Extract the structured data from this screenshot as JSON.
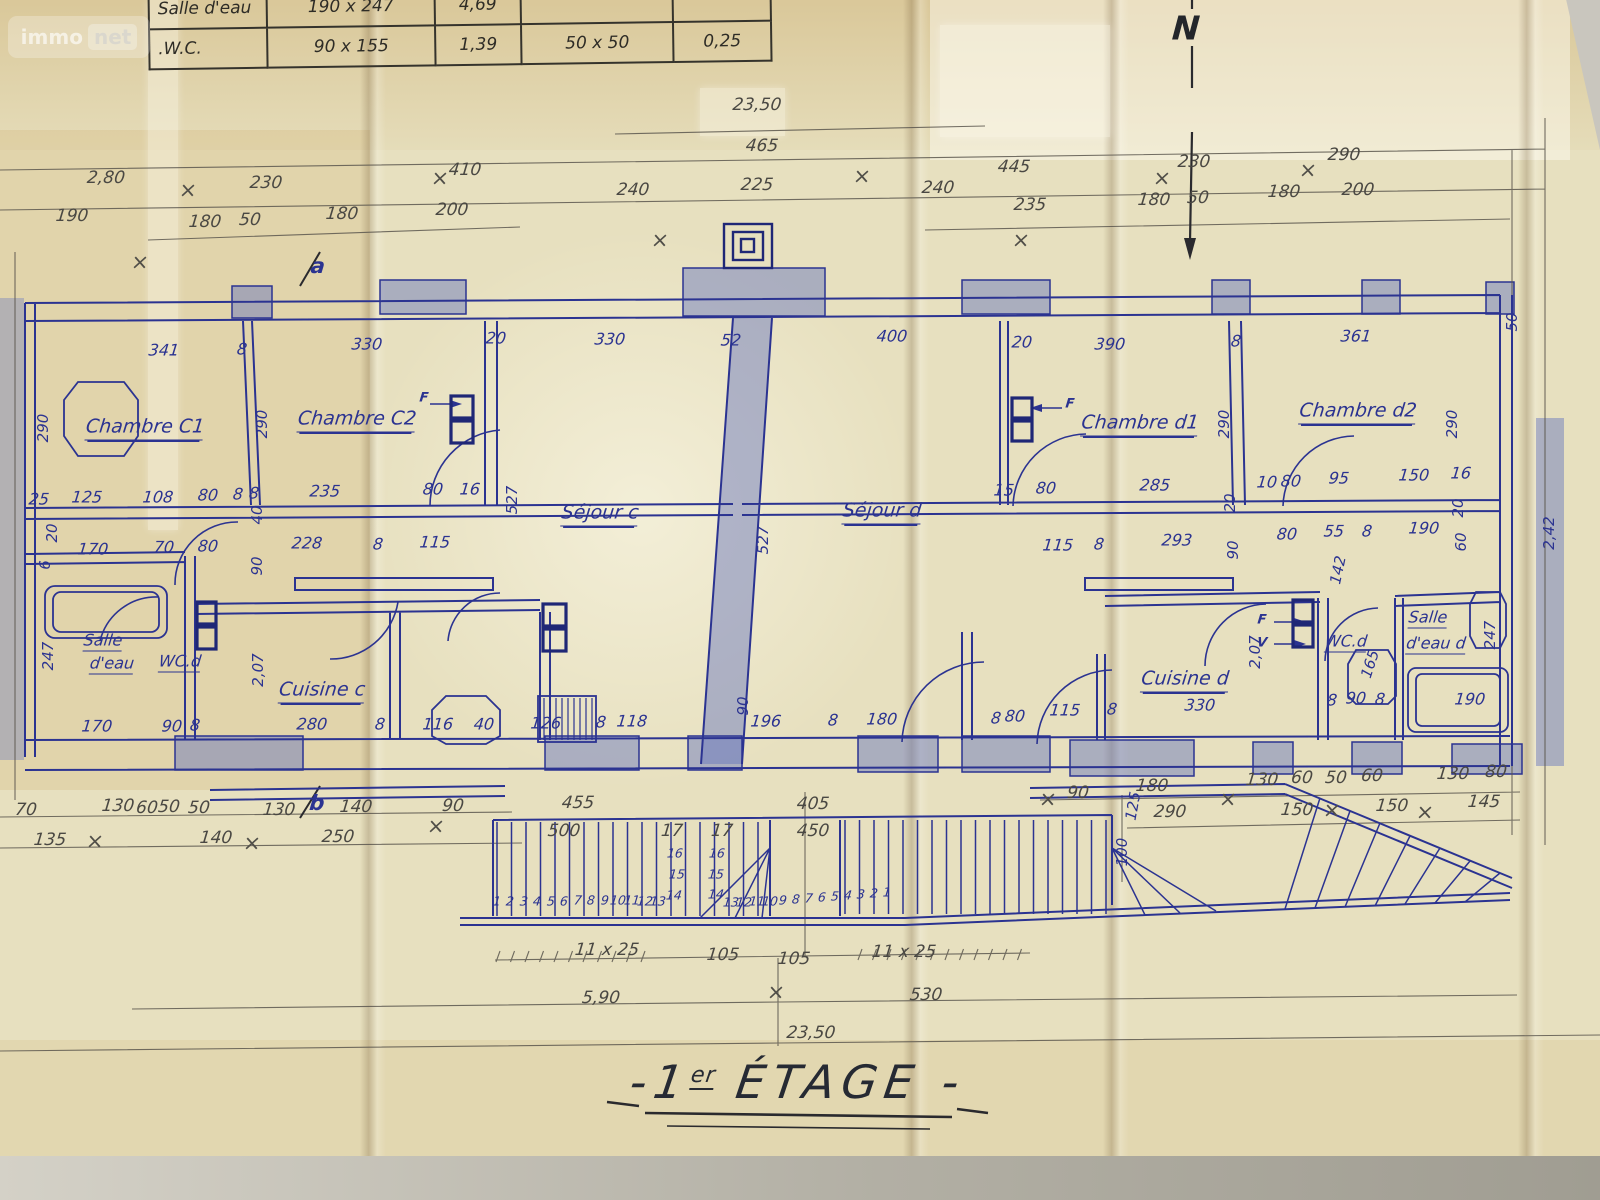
{
  "title": {
    "dash_left": "-",
    "prefix": "1",
    "sup": "er",
    "main": "ÉTAGE",
    "dash_right": "-"
  },
  "watermark": {
    "part1": "immo",
    "part2": "net"
  },
  "compass_label": "N",
  "plan_name": "1er ÉTAGE floor plan",
  "colors": {
    "paper": "#e7e0bf",
    "ink_blue": "#2b3391",
    "ink_navy": "#1f2776",
    "pencil": "#4a4843",
    "crayon": "#6878bf"
  },
  "schedule_table": {
    "rows": [
      [
        "Salle d'eau",
        "190 x 247",
        "4,69",
        "",
        ""
      ],
      [
        ".W.C.",
        "90 x 155",
        "1,39",
        "50 x 50",
        "0,25"
      ]
    ]
  },
  "labels": {
    "pencil_dims": [
      [
        "23,50",
        757,
        105
      ],
      [
        "465",
        762,
        146
      ],
      [
        "240",
        633,
        190
      ],
      [
        "225",
        757,
        185
      ],
      [
        "240",
        938,
        188
      ],
      [
        "2,80",
        106,
        178
      ],
      [
        "230",
        266,
        183
      ],
      [
        "410",
        465,
        170
      ],
      [
        "190",
        72,
        216
      ],
      [
        "180",
        205,
        222
      ],
      [
        "50",
        250,
        220
      ],
      [
        "180",
        342,
        214
      ],
      [
        "200",
        452,
        210
      ],
      [
        "445",
        1014,
        167
      ],
      [
        "230",
        1194,
        162
      ],
      [
        "290",
        1344,
        155
      ],
      [
        "235",
        1030,
        205
      ],
      [
        "180",
        1154,
        200
      ],
      [
        "50",
        1198,
        198
      ],
      [
        "180",
        1284,
        192
      ],
      [
        "200",
        1358,
        190
      ],
      [
        "70",
        26,
        810
      ],
      [
        "130",
        118,
        806
      ],
      [
        "60",
        147,
        808
      ],
      [
        "50",
        169,
        807
      ],
      [
        "50",
        199,
        808
      ],
      [
        "130",
        279,
        810
      ],
      [
        "140",
        356,
        807
      ],
      [
        "90",
        453,
        806
      ],
      [
        "135",
        50,
        840
      ],
      [
        "140",
        216,
        838
      ],
      [
        "250",
        338,
        837
      ],
      [
        "455",
        578,
        803
      ],
      [
        "405",
        813,
        804
      ],
      [
        "500",
        564,
        831
      ],
      [
        "17",
        672,
        831
      ],
      [
        "17",
        722,
        831
      ],
      [
        "450",
        813,
        831
      ],
      [
        "90",
        1078,
        793
      ],
      [
        "180",
        1152,
        786
      ],
      [
        "130",
        1262,
        780
      ],
      [
        "60",
        1302,
        778
      ],
      [
        "50",
        1336,
        778
      ],
      [
        "60",
        1372,
        776
      ],
      [
        "130",
        1453,
        774
      ],
      [
        "80",
        1496,
        772
      ],
      [
        "290",
        1170,
        812
      ],
      [
        "150",
        1297,
        810
      ],
      [
        "150",
        1392,
        806
      ],
      [
        "145",
        1484,
        802
      ],
      [
        "11 x 25",
        607,
        950
      ],
      [
        "105",
        723,
        955
      ],
      [
        "105",
        794,
        959
      ],
      [
        "11 x 25",
        904,
        952
      ],
      [
        "5,90",
        601,
        998
      ],
      [
        "530",
        926,
        995
      ],
      [
        "23,50",
        811,
        1033
      ]
    ],
    "blue_dims": [
      [
        "341",
        164,
        350
      ],
      [
        "8",
        242,
        349
      ],
      [
        "330",
        367,
        344
      ],
      [
        "20",
        496,
        338
      ],
      [
        "330",
        610,
        339
      ],
      [
        "52",
        731,
        340
      ],
      [
        "400",
        892,
        336
      ],
      [
        "20",
        1022,
        342
      ],
      [
        "390",
        1110,
        344
      ],
      [
        "8",
        1236,
        341
      ],
      [
        "361",
        1356,
        336
      ],
      [
        "25",
        39,
        499
      ],
      [
        "125",
        87,
        497
      ],
      [
        "108",
        158,
        497
      ],
      [
        "80",
        208,
        495
      ],
      [
        "8",
        238,
        494
      ],
      [
        "8",
        254,
        493
      ],
      [
        "235",
        325,
        491
      ],
      [
        "80",
        433,
        489
      ],
      [
        "16",
        470,
        489
      ],
      [
        "170",
        93,
        549
      ],
      [
        "70",
        164,
        547
      ],
      [
        "80",
        208,
        546
      ],
      [
        "228",
        307,
        543
      ],
      [
        "8",
        378,
        544
      ],
      [
        "115",
        435,
        542
      ],
      [
        "15",
        1004,
        490
      ],
      [
        "80",
        1046,
        488
      ],
      [
        "285",
        1155,
        485
      ],
      [
        "10",
        1267,
        482
      ],
      [
        "80",
        1291,
        481
      ],
      [
        "95",
        1339,
        478
      ],
      [
        "150",
        1414,
        475
      ],
      [
        "16",
        1461,
        473
      ],
      [
        "115",
        1058,
        545
      ],
      [
        "8",
        1099,
        544
      ],
      [
        "293",
        1177,
        540
      ],
      [
        "80",
        1287,
        534
      ],
      [
        "55",
        1334,
        531
      ],
      [
        "8",
        1367,
        531
      ],
      [
        "190",
        1424,
        528
      ],
      [
        "170",
        97,
        726
      ],
      [
        "90",
        172,
        726
      ],
      [
        "8",
        195,
        725
      ],
      [
        "280",
        312,
        724
      ],
      [
        "8",
        380,
        724
      ],
      [
        "116",
        438,
        724
      ],
      [
        "40",
        484,
        724
      ],
      [
        "126",
        546,
        723
      ],
      [
        "8",
        601,
        722
      ],
      [
        "118",
        632,
        721
      ],
      [
        "196",
        766,
        721
      ],
      [
        "8",
        833,
        720
      ],
      [
        "180",
        882,
        719
      ],
      [
        "8",
        996,
        718
      ],
      [
        "80",
        1015,
        716
      ],
      [
        "115",
        1065,
        710
      ],
      [
        "8",
        1112,
        709
      ],
      [
        "330",
        1200,
        705
      ],
      [
        "8",
        1332,
        700
      ],
      [
        "90",
        1356,
        698
      ],
      [
        "8",
        1380,
        699
      ],
      [
        "190",
        1470,
        699
      ]
    ],
    "vertical_dims": [
      [
        "290",
        43,
        428
      ],
      [
        "290",
        262,
        424
      ],
      [
        "527",
        512,
        500
      ],
      [
        "527",
        763,
        540
      ],
      [
        "290",
        1224,
        424
      ],
      [
        "290",
        1452,
        424
      ],
      [
        "247",
        48,
        656
      ],
      [
        "2,07",
        258,
        670
      ],
      [
        "90",
        257,
        566
      ],
      [
        "40",
        257,
        515
      ],
      [
        "20",
        52,
        533
      ],
      [
        "6",
        45,
        565
      ],
      [
        "90",
        743,
        706
      ],
      [
        "20",
        1230,
        503
      ],
      [
        "90",
        1233,
        550
      ],
      [
        "142",
        1338,
        570,
        -78
      ],
      [
        "20",
        1458,
        508
      ],
      [
        "60",
        1461,
        542
      ],
      [
        "2,07",
        1255,
        652
      ],
      [
        "165",
        1370,
        664,
        -72
      ],
      [
        "247",
        1490,
        635
      ],
      [
        "100",
        1122,
        852
      ],
      [
        "125",
        1133,
        806,
        -80
      ],
      [
        "2,42",
        1549,
        533
      ],
      [
        "50",
        1512,
        322
      ]
    ],
    "rooms": [
      [
        "Chambre C1",
        145,
        428
      ],
      [
        "Chambre C2",
        357,
        420
      ],
      [
        "Séjour c",
        600,
        514
      ],
      [
        "Séjour d",
        882,
        512
      ],
      [
        "Chambre d1",
        1140,
        424
      ],
      [
        "Chambre d2",
        1358,
        412
      ],
      [
        "Cuisine c",
        322,
        691
      ],
      [
        "Cuisine d",
        1185,
        680
      ]
    ],
    "rooms_small": [
      [
        "Salle",
        103,
        641
      ],
      [
        "d'eau",
        112,
        664
      ],
      [
        "WC.d",
        180,
        662
      ],
      [
        "WC.d",
        1346,
        642
      ],
      [
        "Salle",
        1428,
        618
      ],
      [
        "d'eau d",
        1436,
        644
      ]
    ],
    "stair_numbers": [
      [
        "1",
        497,
        901
      ],
      [
        "2",
        510,
        901
      ],
      [
        "3",
        524,
        901
      ],
      [
        "4",
        537,
        901
      ],
      [
        "5",
        551,
        901
      ],
      [
        "6",
        564,
        901
      ],
      [
        "7",
        578,
        900
      ],
      [
        "8",
        591,
        900
      ],
      [
        "9",
        605,
        900
      ],
      [
        "10",
        618,
        900
      ],
      [
        "11",
        632,
        900
      ],
      [
        "12",
        645,
        901
      ],
      [
        "13",
        658,
        901
      ],
      [
        "16",
        675,
        853
      ],
      [
        "16",
        717,
        853
      ],
      [
        "15",
        677,
        874
      ],
      [
        "15",
        716,
        874
      ],
      [
        "14",
        674,
        895
      ],
      [
        "14",
        716,
        894
      ],
      [
        "13",
        731,
        902
      ],
      [
        "12",
        744,
        902
      ],
      [
        "11",
        757,
        901
      ],
      [
        "10",
        770,
        901
      ],
      [
        "9",
        783,
        900
      ],
      [
        "8",
        796,
        899
      ],
      [
        "7",
        809,
        898
      ],
      [
        "6",
        822,
        897
      ],
      [
        "5",
        835,
        896
      ],
      [
        "4",
        848,
        895
      ],
      [
        "3",
        861,
        894
      ],
      [
        "2",
        874,
        893
      ],
      [
        "1",
        887,
        892
      ]
    ],
    "markers": [
      [
        "a",
        318,
        266
      ],
      [
        "b",
        317,
        803
      ]
    ],
    "window_marks": [
      [
        "F",
        424,
        398
      ],
      [
        "F",
        1070,
        404
      ],
      [
        "F",
        1262,
        620
      ],
      [
        "V",
        1262,
        643
      ]
    ],
    "crosses": [
      [
        188,
        190
      ],
      [
        440,
        178
      ],
      [
        862,
        176
      ],
      [
        1162,
        178
      ],
      [
        1308,
        170
      ],
      [
        95,
        841
      ],
      [
        252,
        843
      ],
      [
        436,
        826
      ],
      [
        776,
        992
      ],
      [
        1048,
        799
      ],
      [
        1228,
        799
      ],
      [
        1332,
        810
      ],
      [
        140,
        262
      ],
      [
        660,
        240
      ],
      [
        1021,
        240
      ],
      [
        1425,
        812
      ]
    ]
  }
}
